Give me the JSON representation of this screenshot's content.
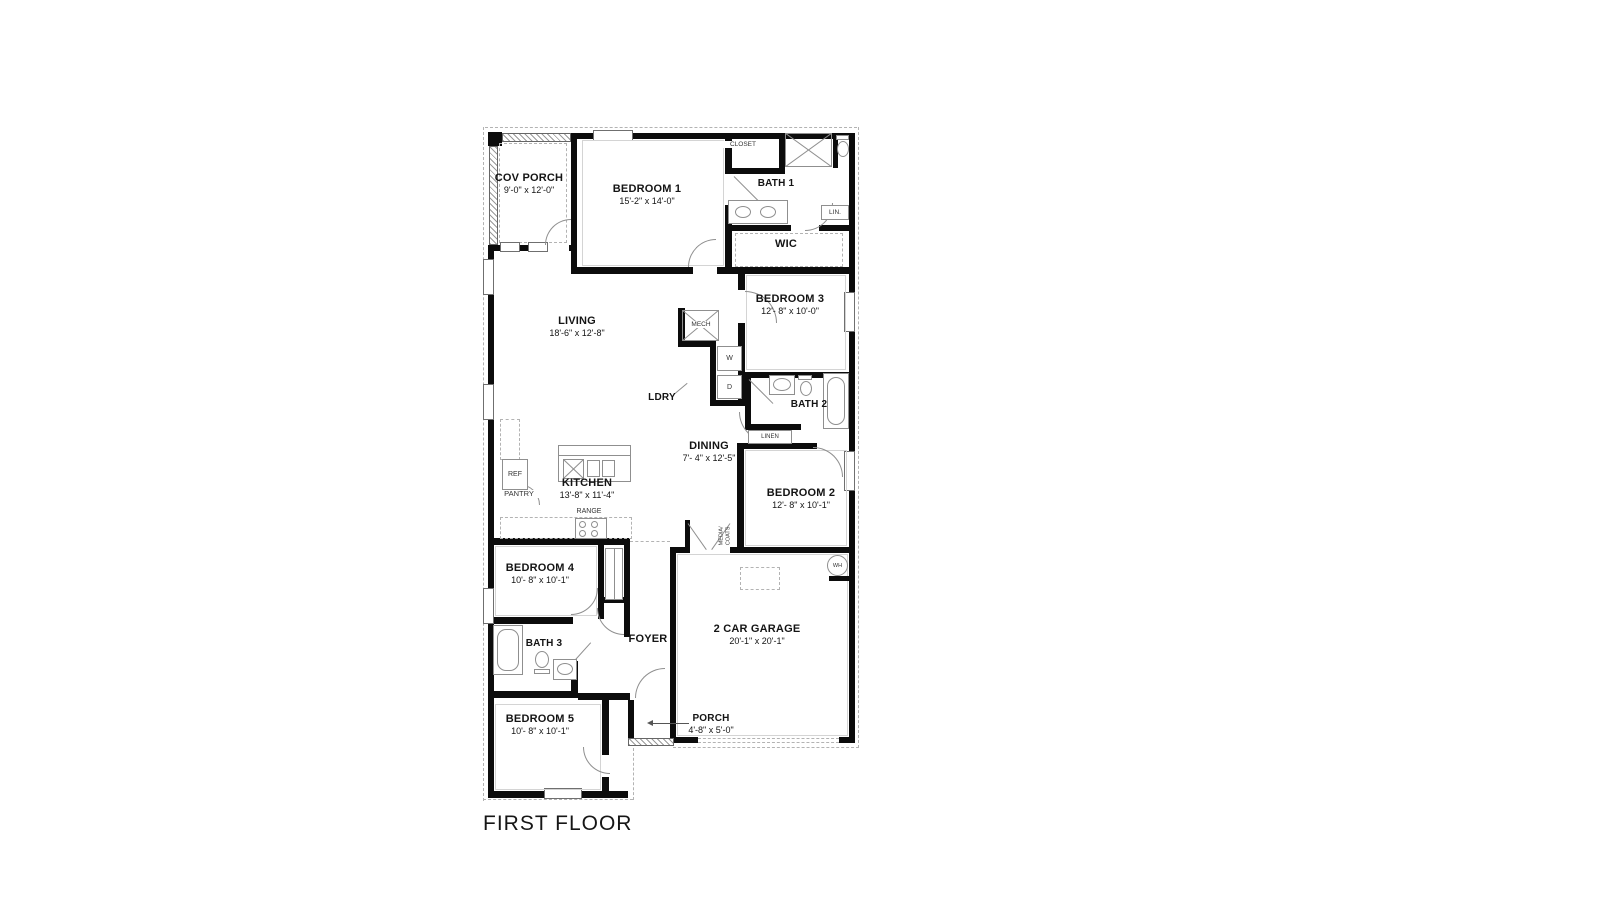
{
  "title": "FIRST FLOOR",
  "rooms": {
    "cov_porch": {
      "name": "COV PORCH",
      "dims": "9'-0\" x 12'-0\""
    },
    "bedroom1": {
      "name": "BEDROOM 1",
      "dims": "15'-2\" x 14'-0\""
    },
    "closet": {
      "name": "CLOSET"
    },
    "bath1": {
      "name": "BATH 1"
    },
    "lin": {
      "name": "LIN."
    },
    "wic": {
      "name": "WIC"
    },
    "living": {
      "name": "LIVING",
      "dims": "18'-6\" x 12'-8\""
    },
    "bedroom3": {
      "name": "BEDROOM 3",
      "dims": "12'- 8\" x 10'-0\""
    },
    "mech": {
      "name": "MECH"
    },
    "laundry": {
      "name": "LDRY",
      "washer": "W",
      "dryer": "D"
    },
    "dining": {
      "name": "DINING",
      "dims": "7'- 4\" x 12'-5\""
    },
    "bath2": {
      "name": "BATH 2"
    },
    "linen": {
      "name": "LINEN"
    },
    "bedroom2": {
      "name": "BEDROOM 2",
      "dims": "12'- 8\" x 10'-1\""
    },
    "kitchen": {
      "name": "KITCHEN",
      "dims": "13'-8\" x 11'-4\""
    },
    "ref": {
      "name": "REF"
    },
    "pantry": {
      "name": "PANTRY"
    },
    "range": {
      "name": "RANGE"
    },
    "media_coats": {
      "line1": "MEDIA/",
      "line2": "COATS"
    },
    "bedroom4": {
      "name": "BEDROOM 4",
      "dims": "10'- 8\" x 10'-1\""
    },
    "foyer": {
      "name": "FOYER"
    },
    "bath3": {
      "name": "BATH 3"
    },
    "garage": {
      "name": "2 CAR GARAGE",
      "dims": "20'-1\" x 20'-1\""
    },
    "wh": {
      "name": "WH"
    },
    "porch": {
      "name": "PORCH",
      "dims": "4'-8\" x 5'-0\""
    },
    "bedroom5": {
      "name": "BEDROOM 5",
      "dims": "10'- 8\" x 10'-1\""
    }
  },
  "colors": {
    "wall": "#0c0c0c",
    "fixture": "#8f8f8f",
    "dash": "#b3b3b3",
    "text": "#141414"
  }
}
